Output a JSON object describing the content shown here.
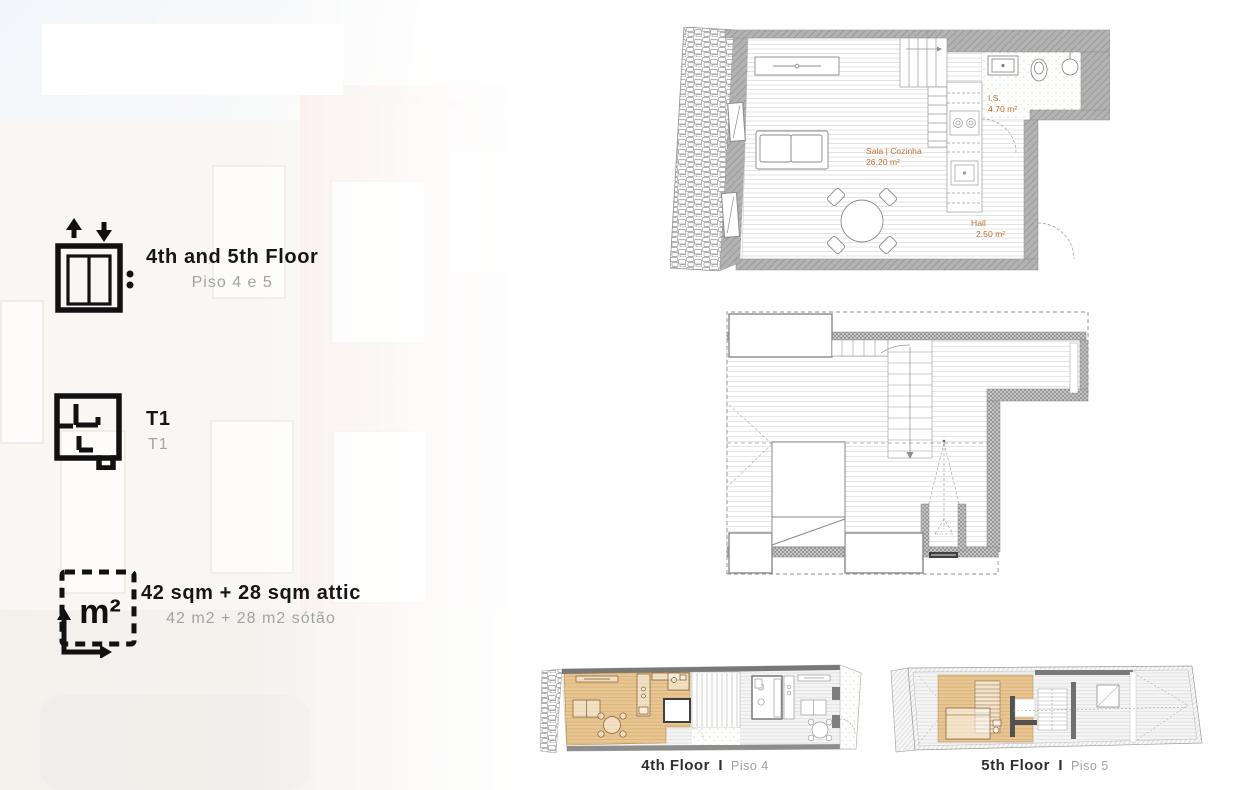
{
  "features": [
    {
      "icon": "elevator-icon",
      "title": "4th and 5th Floor",
      "subtitle": "Piso 4 e 5"
    },
    {
      "icon": "floorplan-icon",
      "title": "T1",
      "subtitle": "T1"
    },
    {
      "icon": "area-icon",
      "title": "42 sqm + 28 sqm attic",
      "subtitle": "42 m2 + 28 m2 sótão"
    }
  ],
  "area_icon_label": "m²",
  "main_plan": {
    "rooms": [
      {
        "name": "Sala | Cozinha",
        "area": "26.20 m²"
      },
      {
        "name": "I.S.",
        "area": "4.70 m²"
      },
      {
        "name": "Hall",
        "area": "2.50 m²"
      }
    ]
  },
  "floor_captions": [
    {
      "title": "4th Floor",
      "separator": "I",
      "subtitle": "Piso 4"
    },
    {
      "title": "5th Floor",
      "separator": "I",
      "subtitle": "Piso 5"
    }
  ],
  "colors": {
    "room_label_accent": "#BF7236",
    "unit_highlight_tan": "#E7C693",
    "wall_gray": "#ABABAB",
    "subtitle_gray": "#A3A3A3",
    "caption_dark": "#2E2E2E"
  }
}
